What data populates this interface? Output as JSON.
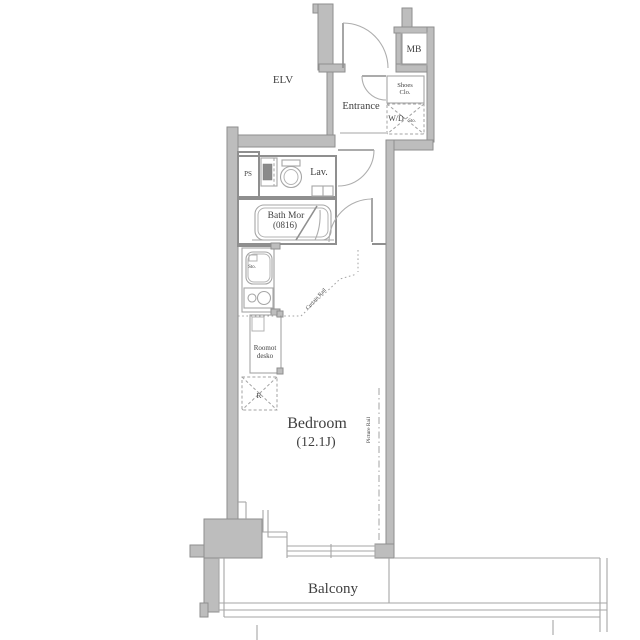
{
  "plan": {
    "labels": {
      "elv": "ELV",
      "mb": "MB",
      "entrance": "Entrance",
      "shoes_line1": "Shoes",
      "shoes_line2": "Clo.",
      "wd": "W/D",
      "wd_small": "Sto.",
      "ps": "PS",
      "lav": "Lav.",
      "bath_line1": "Bath Mor",
      "bath_line2": "(0816)",
      "sink_small": "Sto.",
      "unit_line1": "Roomot",
      "unit_line2": "desko",
      "refrigerator_box": "R",
      "bedroom_line1": "Bedroom",
      "bedroom_line2": "(12.1J)",
      "picture_rail": "Picture Rail",
      "curtain_rail": "Curtain Rail",
      "balcony": "Balcony"
    },
    "colors": {
      "background": "#ffffff",
      "wall_fill": "#bdbdbd",
      "wall_stroke": "#8e8e8e",
      "text": "#3f3f3f"
    }
  }
}
